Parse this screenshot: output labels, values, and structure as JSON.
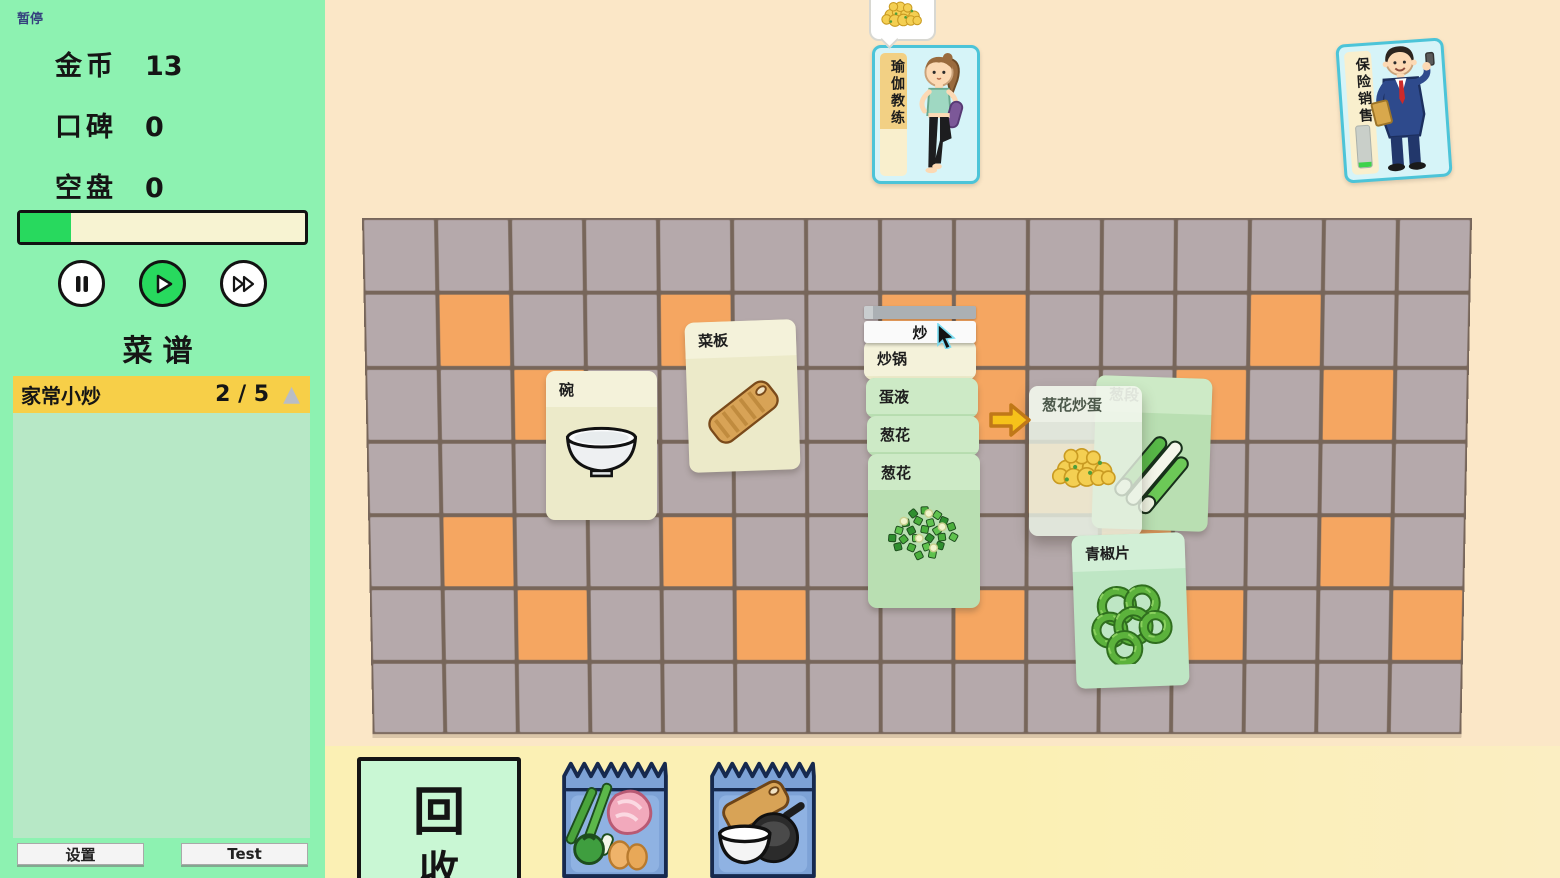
{
  "colors": {
    "bg_cream": "#fbe7c7",
    "bottom_strip": "#fbf0b4",
    "sidebar_bg": "#8df2b1",
    "panel_bg": "#b7e8c6",
    "recipe_header_bg": "#f7cf48",
    "progress_fill": "#28d95e",
    "progress_track": "#f7f3d2",
    "tile_gray": "#b5a9ab",
    "tile_orange": "#f5a661",
    "grout": "#77665a",
    "card_cream": "#eceac9",
    "card_cream_head": "#f4f2da",
    "card_green": "#b9dfb2",
    "card_green_head": "#cdeac6",
    "card_mint": "#bee6c4",
    "card_mint_head": "#d2efd6",
    "customer_border": "#4cc4d8",
    "customer_bg": "#d6f4f8",
    "strip_yellow": "#f2d084",
    "strip_pale": "#f9efcd",
    "recycle_bg": "#c9f7d4",
    "pack_blue": "#7da2d6",
    "pack_dark": "#16294e",
    "arrow_yellow": "#f6c21a",
    "arrow_outline": "#c07818"
  },
  "hud": {
    "pause_label": "暂停",
    "stats": [
      {
        "label": "金币",
        "value": "13"
      },
      {
        "label": "口碑",
        "value": "0"
      },
      {
        "label": "空盘",
        "value": "0"
      }
    ],
    "progress_percent": 18,
    "recipe_title": "菜谱",
    "recipes": [
      {
        "name": "家常小炒",
        "progress": "2 / 5"
      }
    ],
    "settings_label": "设置",
    "test_label": "Test"
  },
  "customers": [
    {
      "name": "瑜伽教练",
      "timer_percent": 62,
      "order_art": "eggs"
    },
    {
      "name": "保险销售",
      "timer_percent": 12
    }
  ],
  "floor": {
    "cols": 15,
    "rows": 7,
    "orange_cells": [
      [
        1,
        1
      ],
      [
        1,
        4
      ],
      [
        1,
        7
      ],
      [
        1,
        8
      ],
      [
        1,
        12
      ],
      [
        2,
        2
      ],
      [
        2,
        8
      ],
      [
        2,
        11
      ],
      [
        2,
        13
      ],
      [
        3,
        9
      ],
      [
        4,
        1
      ],
      [
        4,
        4
      ],
      [
        4,
        10
      ],
      [
        4,
        13
      ],
      [
        5,
        2
      ],
      [
        5,
        5
      ],
      [
        5,
        8
      ],
      [
        5,
        11
      ],
      [
        5,
        14
      ]
    ]
  },
  "board": {
    "cook_progress_percent": 8,
    "action": {
      "label": "炒",
      "x": 864,
      "y": 321,
      "w": 112,
      "h": 22
    },
    "cook_bar": {
      "x": 864,
      "y": 306,
      "w": 112,
      "h": 13
    },
    "arrow": {
      "x": 987,
      "y": 397,
      "w": 46,
      "h": 46
    },
    "cards": [
      {
        "id": "bowl",
        "title": "碗",
        "style": "cream",
        "art": "bowl",
        "x": 546,
        "y": 371,
        "w": 111,
        "h": 149,
        "rot": 0
      },
      {
        "id": "cutting-board",
        "title": "菜板",
        "style": "cream",
        "art": "board",
        "x": 687,
        "y": 321,
        "w": 111,
        "h": 150,
        "rot": -2
      },
      {
        "id": "wok",
        "title": "炒锅",
        "style": "cream",
        "x": 864,
        "y": 340,
        "w": 112,
        "h": 40,
        "rot": 0,
        "partial": true
      },
      {
        "id": "egg-liquid",
        "title": "蛋液",
        "style": "green",
        "x": 866,
        "y": 378,
        "w": 112,
        "h": 40,
        "rot": 0,
        "partial": true
      },
      {
        "id": "scallion-bits-1",
        "title": "葱花",
        "style": "green",
        "x": 867,
        "y": 416,
        "w": 112,
        "h": 40,
        "rot": 0,
        "partial": true
      },
      {
        "id": "scallion-bits-2",
        "title": "葱花",
        "style": "green",
        "art": "chopped",
        "x": 868,
        "y": 454,
        "w": 112,
        "h": 154,
        "rot": 0
      },
      {
        "id": "scallion-segments",
        "title": "葱段",
        "style": "green",
        "art": "segments",
        "x": 1094,
        "y": 377,
        "w": 116,
        "h": 153,
        "rot": 2
      },
      {
        "id": "result-preview",
        "title": "葱花炒蛋",
        "style": "ghost",
        "art": "eggs",
        "x": 1029,
        "y": 386,
        "w": 113,
        "h": 150,
        "rot": 0
      },
      {
        "id": "pepper-slices",
        "title": "青椒片",
        "style": "mint",
        "art": "rings",
        "x": 1074,
        "y": 534,
        "w": 113,
        "h": 153,
        "rot": -2
      }
    ]
  },
  "bottom": {
    "recycle_glyph": "回",
    "recycle_glyph_hidden": "收",
    "packs": [
      {
        "id": "ingredients",
        "art": "pack-food"
      },
      {
        "id": "tools",
        "art": "pack-tools"
      }
    ]
  }
}
